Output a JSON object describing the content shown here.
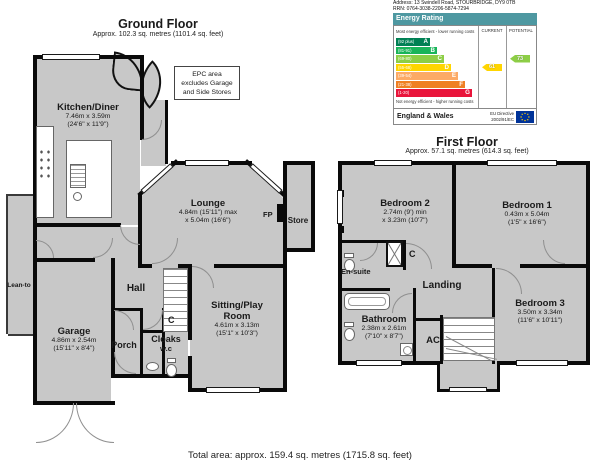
{
  "meta": {
    "total_area": "Total area: approx. 159.4 sq. metres (1715.8 sq. feet)"
  },
  "ground_floor": {
    "title": "Ground Floor",
    "subtitle": "Approx. 102.3 sq. metres (1101.4 sq. feet)",
    "epc_note_line1": "EPC area",
    "epc_note_line2": "excludes Garage",
    "epc_note_line3": "and Side Stores",
    "rooms": {
      "kitchen": {
        "name": "Kitchen/Diner",
        "dims": "7.46m x 3.59m",
        "dims_ft": "(24'6\" x 11'9\")"
      },
      "lounge": {
        "name": "Lounge",
        "dims": "4.84m (15'11\") max",
        "dims_ft": "x 5.04m (16'6\")"
      },
      "store": {
        "name": "Store"
      },
      "fp": {
        "name": "FP"
      },
      "lean_to": {
        "name": "Lean-to"
      },
      "garage": {
        "name": "Garage",
        "dims": "4.86m x 2.54m",
        "dims_ft": "(15'11\" x 8'4\")"
      },
      "hall": {
        "name": "Hall"
      },
      "porch": {
        "name": "Porch"
      },
      "cloaks": {
        "name": "Cloaks",
        "name2": "w.c"
      },
      "cupboard": {
        "name": "C"
      },
      "sitting": {
        "name1": "Sitting/Play",
        "name2": "Room",
        "dims": "4.61m x 3.13m",
        "dims_ft": "(15'1\" x 10'3\")"
      }
    }
  },
  "first_floor": {
    "title": "First Floor",
    "subtitle": "Approx. 57.1 sq. metres (614.3 sq. feet)",
    "rooms": {
      "bedroom2": {
        "name": "Bedroom 2",
        "dims": "2.74m (9') min",
        "dims_ft": "x 3.23m (10'7\")"
      },
      "bedroom1": {
        "name": "Bedroom 1",
        "dims": "0.43m x 5.04m",
        "dims_ft": "(1'5\" x 16'6\")"
      },
      "bedroom3": {
        "name": "Bedroom 3",
        "dims": "3.50m x 3.34m",
        "dims_ft": "(11'6\" x 10'11\")"
      },
      "bathroom": {
        "name": "Bathroom",
        "dims": "2.38m x 2.61m",
        "dims_ft": "(7'10\" x 8'7\")"
      },
      "ensuite": {
        "name": "En-suite"
      },
      "landing": {
        "name": "Landing"
      },
      "ac": {
        "name": "AC"
      },
      "cupboard": {
        "name": "C"
      }
    }
  },
  "epc": {
    "address_line": "Address: 13 Swindell Road, STOURBRIDGE, DY9 0TB",
    "rrn_line": "RRN: 0764-3038-2206-5874-7294",
    "header": "Energy Rating",
    "header_color": "#4e98a1",
    "top_note": "Most energy efficient - lower running costs",
    "bottom_note": "Not energy efficient - higher running costs",
    "current_label": "CURRENT",
    "potential_label": "POTENTIAL",
    "bands": [
      {
        "letter": "A",
        "range": "(92 plus)",
        "color": "#008054",
        "width": 34
      },
      {
        "letter": "B",
        "range": "(81-91)",
        "color": "#19b459",
        "width": 41
      },
      {
        "letter": "C",
        "range": "(69-80)",
        "color": "#8dce46",
        "width": 48
      },
      {
        "letter": "D",
        "range": "(55-68)",
        "color": "#ffd500",
        "width": 55
      },
      {
        "letter": "E",
        "range": "(39-54)",
        "color": "#fcaa65",
        "width": 62
      },
      {
        "letter": "F",
        "range": "(21-38)",
        "color": "#ef8023",
        "width": 69
      },
      {
        "letter": "G",
        "range": "(1-20)",
        "color": "#e9153b",
        "width": 76
      }
    ],
    "current": {
      "value": "61",
      "color": "#ffd500"
    },
    "potential": {
      "value": "73",
      "color": "#8dce46"
    },
    "footer_left": "England & Wales",
    "eu_line1": "EU Directive",
    "eu_line2": "2002/91/EC"
  }
}
